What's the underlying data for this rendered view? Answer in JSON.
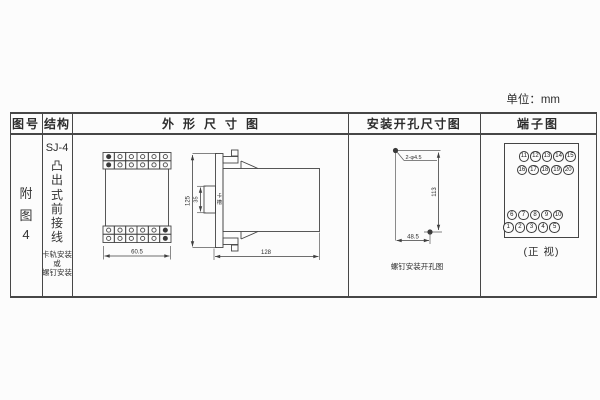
{
  "page": {
    "unit_label": "单位：mm",
    "line_color": "#474747",
    "text_color": "#2e2e2e"
  },
  "table": {
    "headers": {
      "figure_no": "图号",
      "structure": "结构",
      "outline": "外形尺寸图",
      "mounting": "安装开孔尺寸图",
      "terminal": "端子图"
    }
  },
  "row": {
    "figure_no": "附图4",
    "structure": {
      "model": "SJ-4",
      "type": "凸出式前接线",
      "note1": "卡轨安装",
      "note2": "或",
      "note3": "螺钉安装"
    }
  },
  "outline": {
    "front": {
      "width": "60.5",
      "grid": {
        "rows": 2,
        "cols": 6
      }
    },
    "side": {
      "height": "125",
      "notch": "35",
      "notch_label": "卡槽",
      "depth": "128"
    }
  },
  "mounting": {
    "hole_label": "2-φ4.5",
    "vertical_dim": "113",
    "horizontal_dim": "48.5",
    "caption": "螺钉安装开孔图"
  },
  "terminal": {
    "top_rows": [
      [
        "11",
        "12",
        "13",
        "14",
        "15"
      ],
      [
        "16",
        "17",
        "18",
        "19",
        "20"
      ]
    ],
    "bottom_rows": [
      [
        "6",
        "7",
        "8",
        "9",
        "10"
      ],
      [
        "1",
        "2",
        "3",
        "4",
        "5"
      ]
    ],
    "caption": "(正 视)"
  }
}
